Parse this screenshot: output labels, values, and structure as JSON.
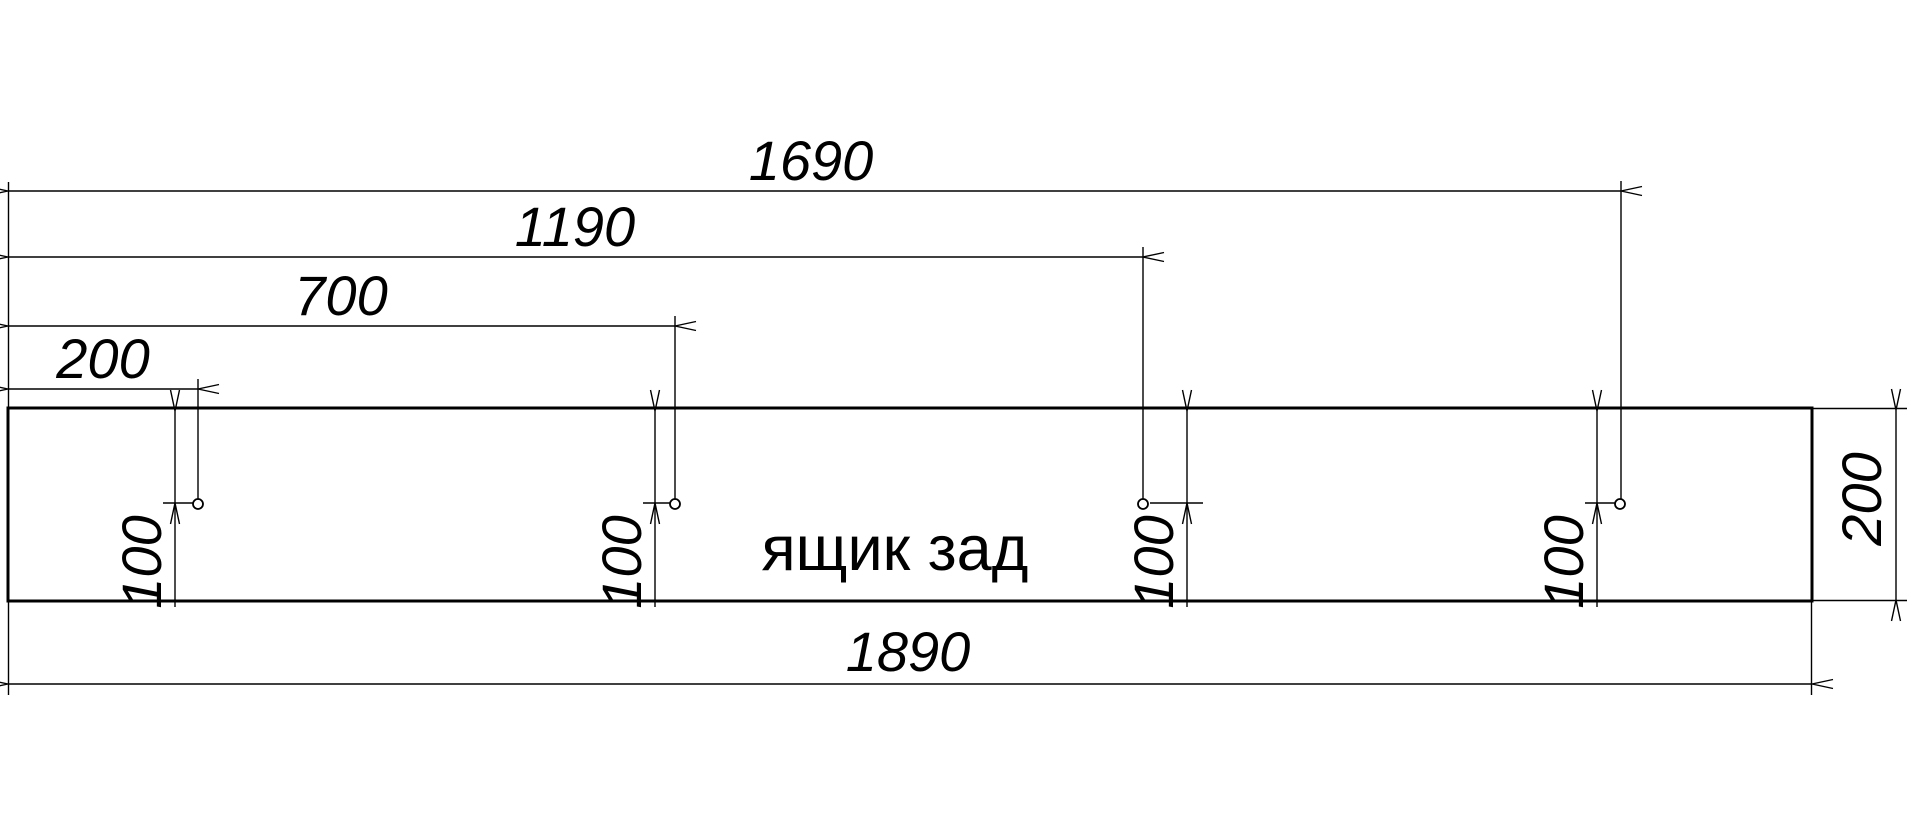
{
  "drawing": {
    "part_label": "ящик зад",
    "top_dims": [
      "1690",
      "1190",
      "700",
      "200"
    ],
    "bottom_dim": "1890",
    "height_dim": "200",
    "hole_dims": [
      "100",
      "100",
      "100",
      "100"
    ],
    "hole_count": 4,
    "colors": {
      "line": "#000000",
      "background": "#ffffff"
    }
  }
}
